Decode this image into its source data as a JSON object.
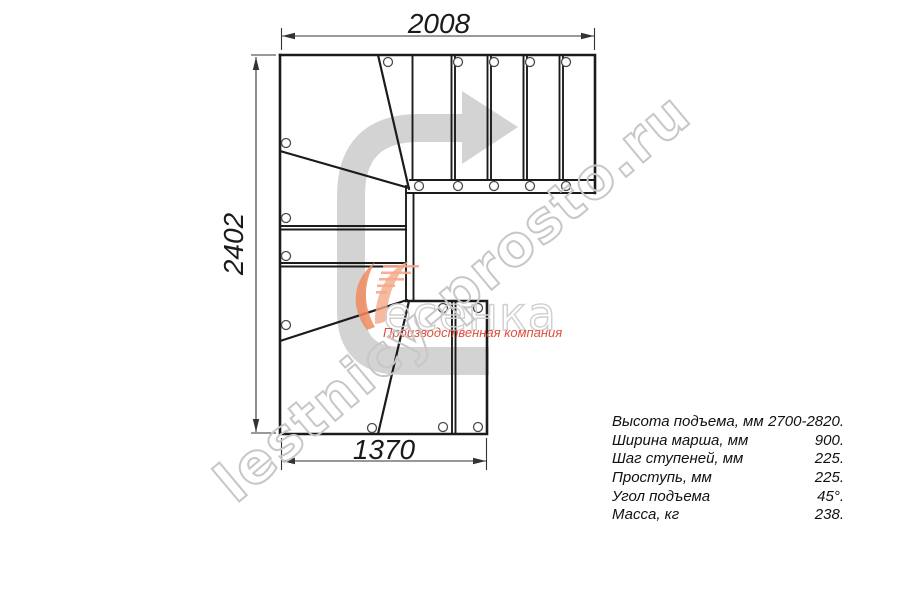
{
  "drawing": {
    "title": "L-shaped staircase plan view",
    "dim_top": "2008",
    "dim_left": "2402",
    "dim_bottom": "1370"
  },
  "specs": {
    "rows": [
      {
        "label": "Высота подъема, мм",
        "value": "2700-2820."
      },
      {
        "label": "Ширина марша, мм",
        "value": "900."
      },
      {
        "label": "Шаг ступеней, мм",
        "value": "225."
      },
      {
        "label": "Проступь, мм",
        "value": "225."
      },
      {
        "label": "Угол подъема",
        "value": "45°."
      },
      {
        "label": "Масса, кг",
        "value": "238."
      }
    ]
  },
  "watermark": {
    "text": "lestnicy-prosto.ru"
  },
  "logo": {
    "name": "Лесенка",
    "visible_text": "есенка",
    "tagline": "Производственная компания"
  },
  "colors": {
    "line": "#1b1b1b",
    "dimension": "#333333",
    "arrow_gray": "#d3d3d3",
    "watermark_gray": "#c7c7c7",
    "logo_orange": "#ee8a5f",
    "logo_orange_light": "#f4a98a",
    "logo_red": "#dd4f3e"
  }
}
